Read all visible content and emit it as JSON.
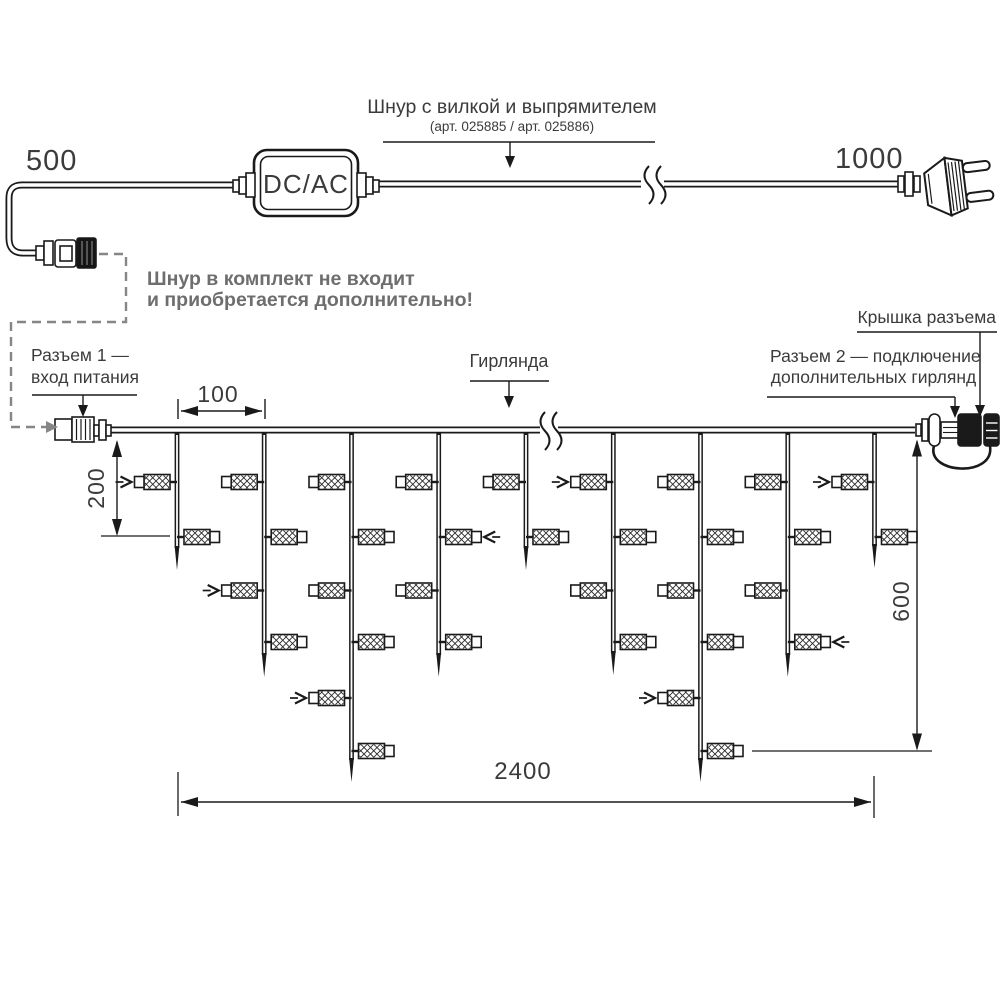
{
  "labels": {
    "len_left": "500",
    "len_right": "1000",
    "converter": "DC/AC",
    "cord_title": "Шнур с вилкой и выпрямителем",
    "cord_subtitle": "(арт. 025885 / арт. 025886)",
    "note_line1": "Шнур в комплект не входит",
    "note_line2": "и приобретается дополнительно!",
    "connector1_line1": "Разъем 1 —",
    "connector1_line2": "вход питания",
    "garland": "Гирлянда",
    "connector2_line1": "Разъем 2 — подключение",
    "connector2_line2": "дополнительных гирлянд",
    "cap": "Крышка разъема",
    "dim_spacing": "100",
    "dim_first_drop": "200",
    "dim_height": "600",
    "dim_length": "2400"
  },
  "colors": {
    "line": "#1a1a1a",
    "text": "#3b3b3b",
    "note_gray": "#6e6e6e",
    "dashed_gray": "#868686"
  },
  "structure": {
    "wire_y": 430,
    "wire_x1": 110,
    "wire_x2": 915,
    "break_x": 545,
    "lamp_level_ys": [
      482,
      537,
      590.5,
      642,
      698,
      751
    ],
    "drops": [
      {
        "x": 177,
        "tip": 570,
        "lamps": [
          {
            "level": 0,
            "side": "L",
            "arrow": true
          },
          {
            "level": 1,
            "side": "R"
          }
        ]
      },
      {
        "x": 264.2,
        "tip": 677,
        "lamps": [
          {
            "level": 0,
            "side": "L"
          },
          {
            "level": 1,
            "side": "R"
          },
          {
            "level": 2,
            "side": "L",
            "arrow": true
          },
          {
            "level": 3,
            "side": "R"
          }
        ]
      },
      {
        "x": 351.5,
        "tip": 782,
        "lamps": [
          {
            "level": 0,
            "side": "L"
          },
          {
            "level": 1,
            "side": "R"
          },
          {
            "level": 2,
            "side": "L"
          },
          {
            "level": 3,
            "side": "R"
          },
          {
            "level": 4,
            "side": "L",
            "arrow": true
          },
          {
            "level": 5,
            "side": "R"
          }
        ]
      },
      {
        "x": 438.7,
        "tip": 677,
        "lamps": [
          {
            "level": 0,
            "side": "L"
          },
          {
            "level": 1,
            "side": "R",
            "arrow": true
          },
          {
            "level": 2,
            "side": "L"
          },
          {
            "level": 3,
            "side": "R"
          }
        ]
      },
      {
        "x": 526,
        "tip": 570,
        "lamps": [
          {
            "level": 0,
            "side": "L"
          },
          {
            "level": 1,
            "side": "R"
          }
        ]
      },
      {
        "x": 613.3,
        "tip": 675,
        "lamps": [
          {
            "level": 0,
            "side": "L",
            "arrow": true
          },
          {
            "level": 1,
            "side": "R"
          },
          {
            "level": 2,
            "side": "L"
          },
          {
            "level": 3,
            "side": "R"
          }
        ]
      },
      {
        "x": 700.5,
        "tip": 782,
        "lamps": [
          {
            "level": 0,
            "side": "L"
          },
          {
            "level": 1,
            "side": "R"
          },
          {
            "level": 2,
            "side": "L"
          },
          {
            "level": 3,
            "side": "R"
          },
          {
            "level": 4,
            "side": "L",
            "arrow": true
          },
          {
            "level": 5,
            "side": "R"
          }
        ]
      },
      {
        "x": 787.8,
        "tip": 677,
        "lamps": [
          {
            "level": 0,
            "side": "L"
          },
          {
            "level": 1,
            "side": "R"
          },
          {
            "level": 2,
            "side": "L"
          },
          {
            "level": 3,
            "side": "R",
            "arrow": true
          }
        ]
      },
      {
        "x": 874.5,
        "tip": 568,
        "lamps": [
          {
            "level": 0,
            "side": "L",
            "arrow": true
          },
          {
            "level": 1,
            "side": "R"
          }
        ]
      }
    ],
    "dimensions": {
      "spacing": {
        "x1": 178,
        "x2": 265,
        "y": 411
      },
      "first_drop": {
        "x": 117,
        "y1": 440,
        "y2": 536,
        "ref_x1": 101,
        "ref_x2": 170
      },
      "height": {
        "x": 917,
        "y1": 439.5,
        "y2": 750.5,
        "ref_x1": 752,
        "ref_x2": 932
      },
      "length": {
        "x1": 181,
        "x2": 871,
        "y": 802,
        "ext_x1": 178,
        "ext_x2": 874
      }
    }
  }
}
